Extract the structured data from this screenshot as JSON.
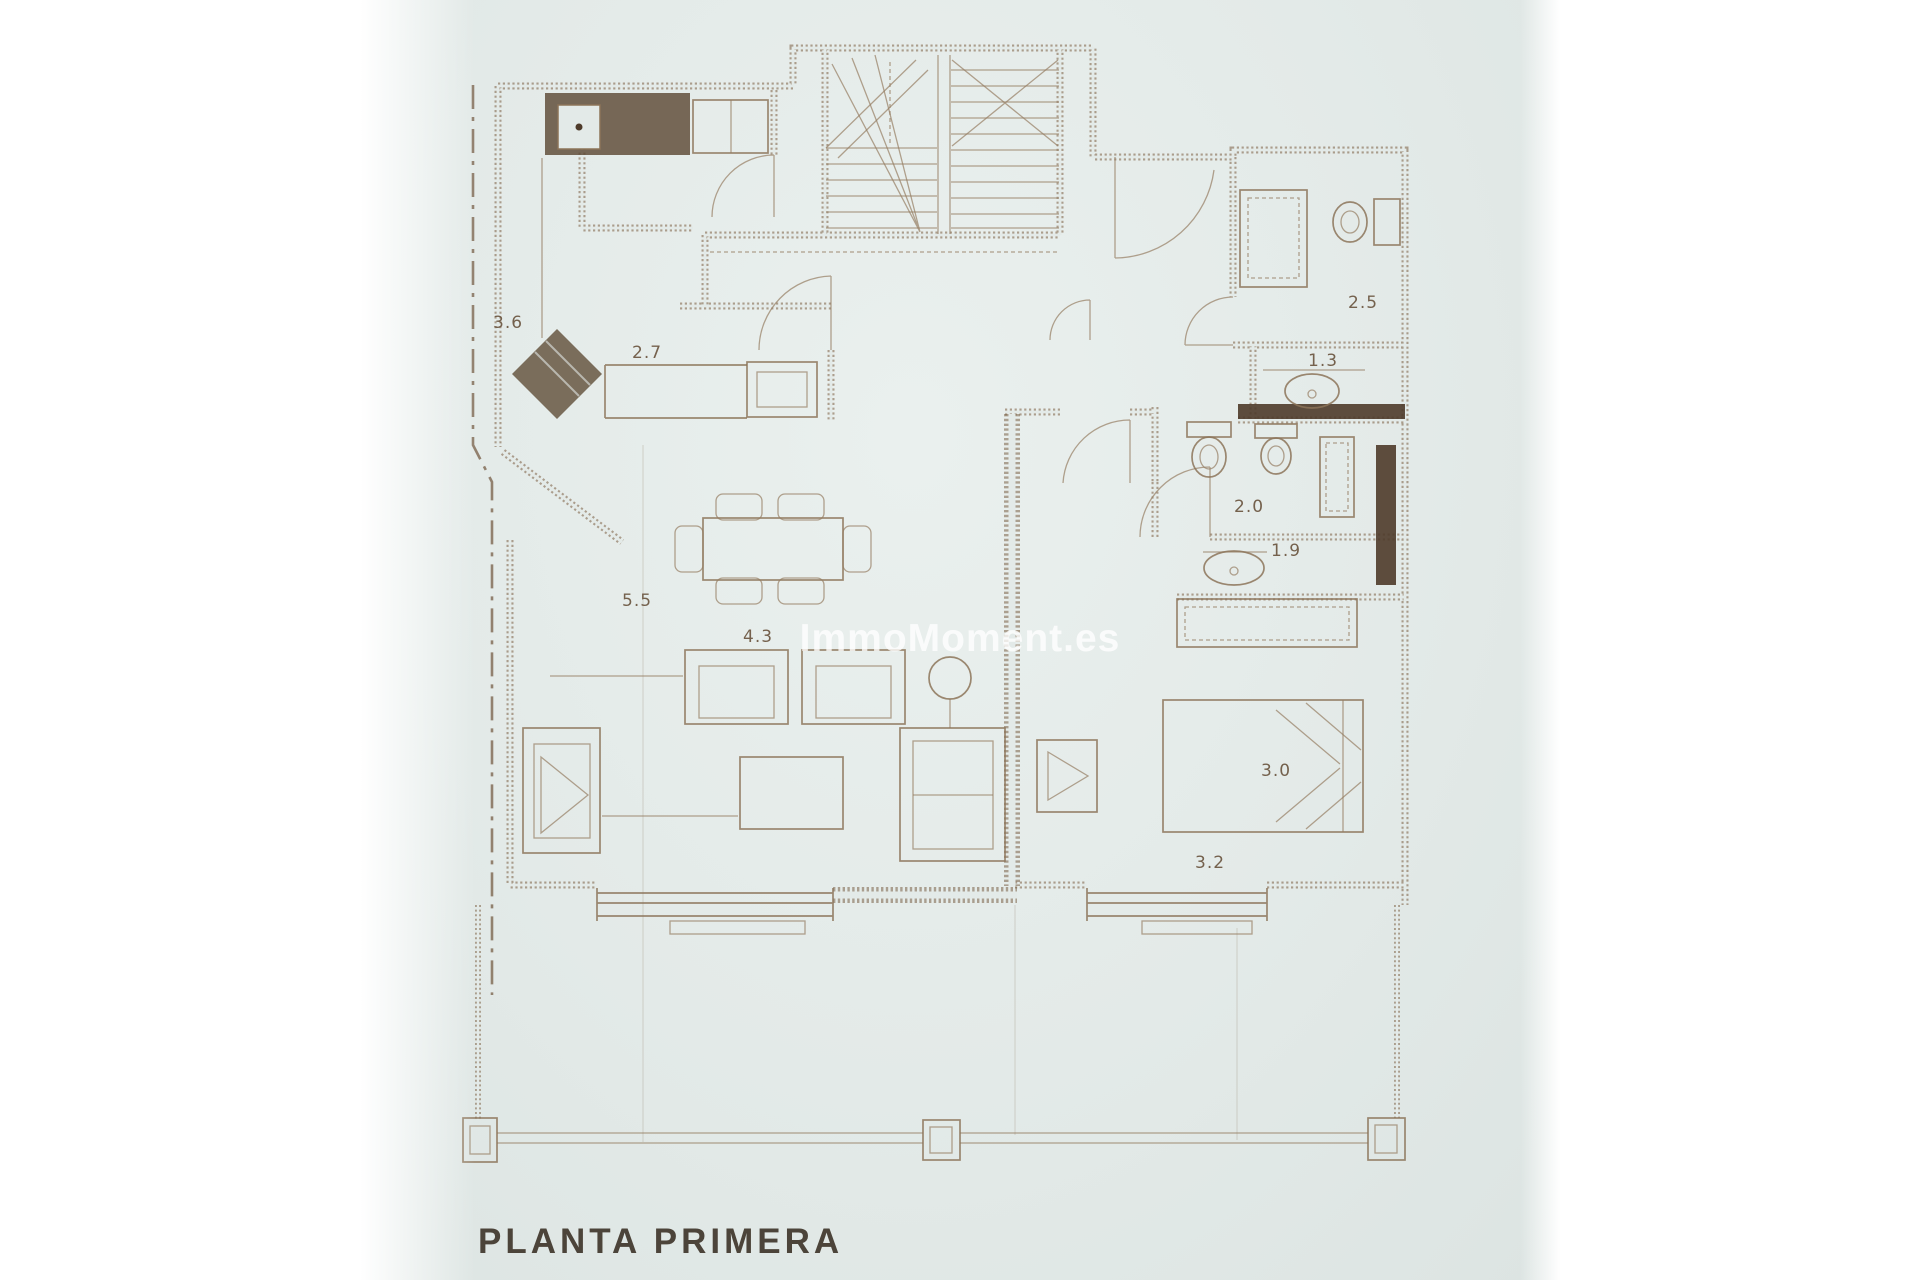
{
  "doc": {
    "title": "PLANTA PRIMERA",
    "watermark": "ImmoMoment.es",
    "colors": {
      "page_background": "#ffffff",
      "paper": "#e3eae8",
      "ink": "#8c7459",
      "dark_wall_fill": "#4e3b2a",
      "title_ink": "#4c443a",
      "watermark_color": "rgba(255,255,255,0.78)"
    },
    "labels": [
      {
        "text": "3.6"
      },
      {
        "text": "2.7"
      },
      {
        "text": "2.5"
      },
      {
        "text": "1.3"
      },
      {
        "text": "2.0"
      },
      {
        "text": "1.9"
      },
      {
        "text": "5.5"
      },
      {
        "text": "4.3"
      },
      {
        "text": "3.0"
      },
      {
        "text": "3.2"
      }
    ],
    "features": [
      "staircase",
      "kitchen-counter",
      "kitchen-sink",
      "corner-hob-unit",
      "oven",
      "dining-table",
      "dining-chairs",
      "armchairs",
      "sofa",
      "coffee-table",
      "floor-lamp-side-table",
      "tv-unit-living",
      "tv-unit-bedroom",
      "toilet",
      "bidet",
      "shower",
      "washbasin",
      "wardrobe",
      "double-bed",
      "windows",
      "terrace-railing",
      "terrace-posts"
    ]
  }
}
